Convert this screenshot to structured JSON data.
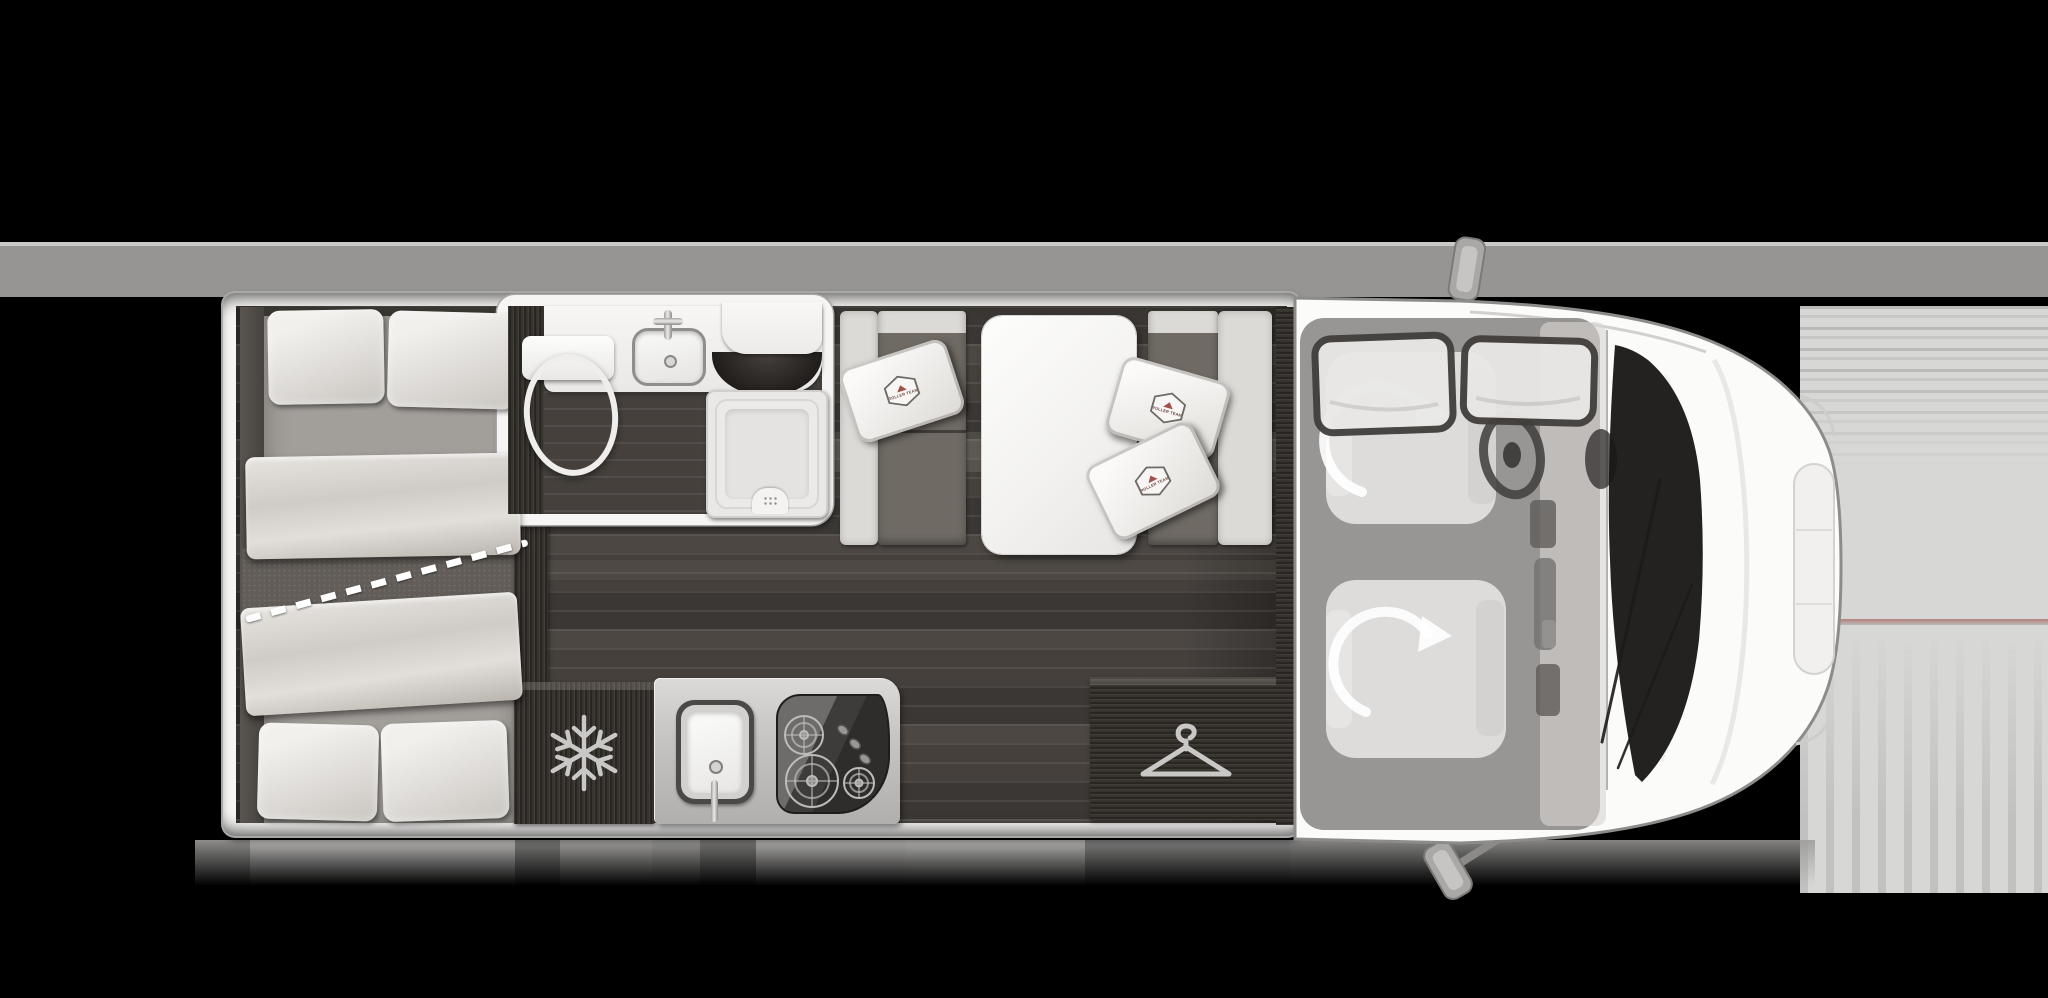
{
  "theme": {
    "bg": "#000000",
    "band": "#969593",
    "band_line": "#c9c9c7",
    "panel": "#d7d7d5",
    "accent": "#b2817b",
    "wall": "#f6f5f4",
    "wall_edge": "#a9a8a6",
    "floor": "#45403c",
    "wood": "#332f2b",
    "mattress": "#a29e9a",
    "pillow": "#d9d6d2",
    "pillow_hi": "#f2f0ed",
    "divider": "#625d58",
    "dash": "#ffffff",
    "bench_dark": "#6f6a64",
    "bench_light": "#dcdad6",
    "porcelain": "#fdfdfc",
    "tray": "#e9e8e6",
    "unit": "#b0afad",
    "hob": "#2f2d2b",
    "icon": "#c9c8c6",
    "logo_red": "#a0524a",
    "body": "#fbfbfa",
    "outline": "#8c8c8a",
    "glass": "#171614",
    "ghost_seat": "#e7e6e4",
    "arrow": "#ffffff"
  },
  "floorplan": {
    "pillow_logo_text": "ROLLER TEAM",
    "icons": {
      "fridge": "snowflake-icon",
      "wardrobe": "clothes-hanger-icon",
      "shower": "drain-grid-icon",
      "cab_seats": "rotate-arrow-icon",
      "hob": "gas-burner-icon",
      "sink": "basin-drain-icon"
    }
  }
}
